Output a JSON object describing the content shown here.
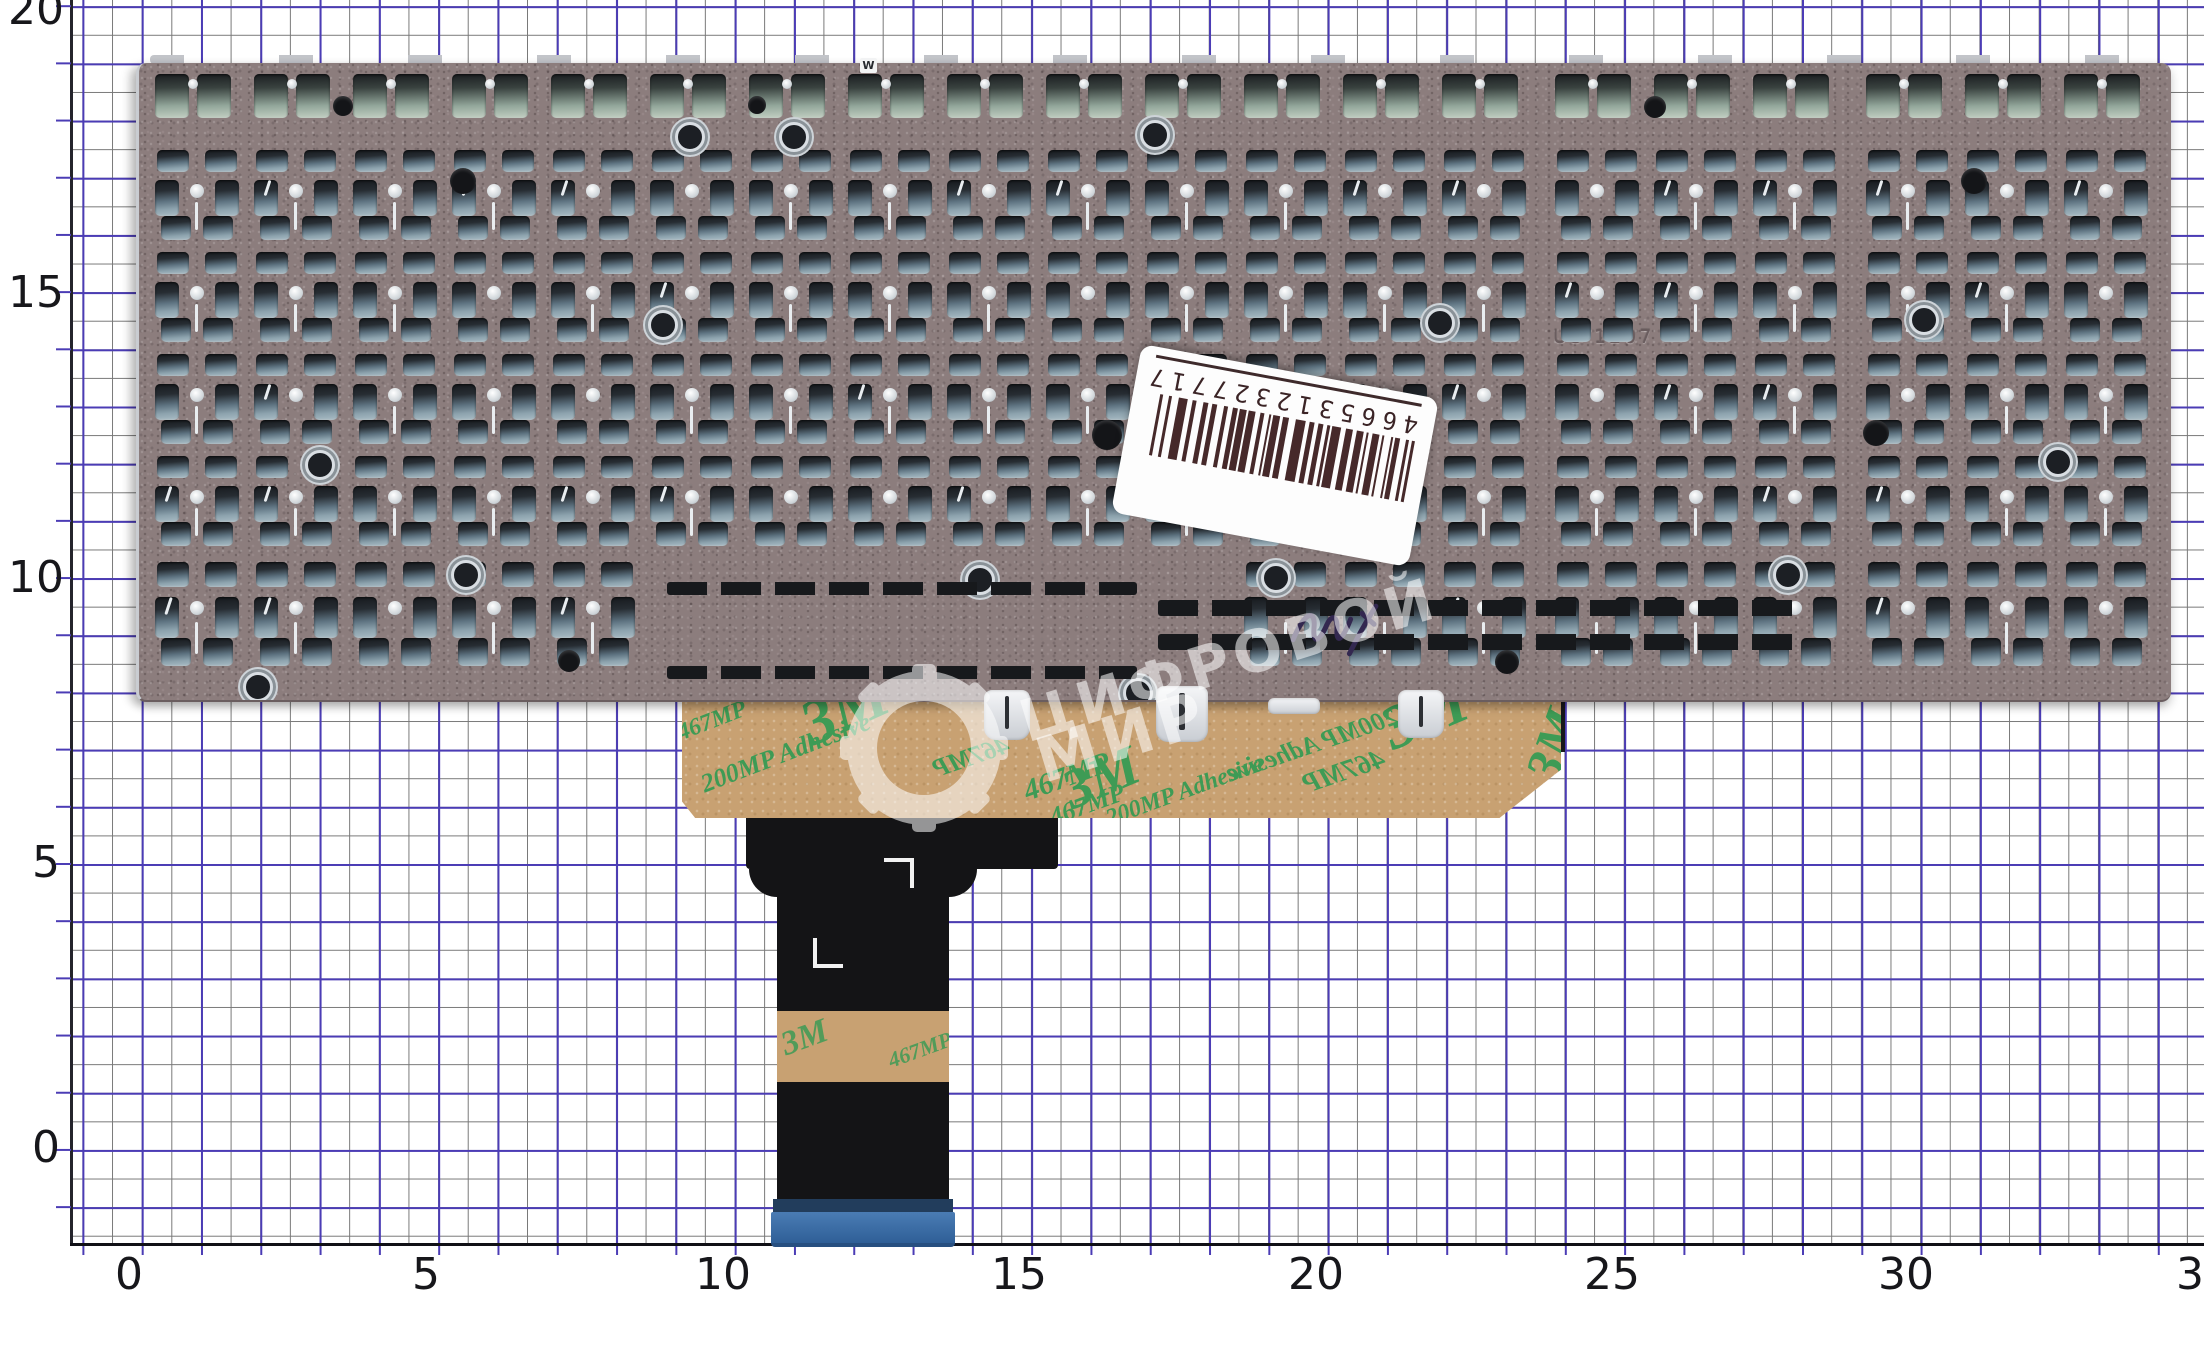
{
  "photo_subject": "laptop keyboard metal backplate on millimeter graph paper",
  "ruler": {
    "y_labels": [
      "20",
      "15",
      "10",
      "5",
      "0"
    ],
    "x_labels": [
      "0",
      "5",
      "10",
      "15",
      "20",
      "25",
      "30",
      "35"
    ]
  },
  "sticker": {
    "barcode_digits": "4665312327717"
  },
  "adhesive": {
    "brand": "3M",
    "code": "467MP",
    "name": "200MP Adhesive"
  },
  "plate": {
    "stamp_left": "US V1",
    "stamp_right": "US 1207",
    "key_marker": "W",
    "rows": [
      {
        "y": 74,
        "h": 48,
        "type": "fn"
      },
      {
        "y": 150,
        "h": 92,
        "type": "std"
      },
      {
        "y": 252,
        "h": 92,
        "type": "std"
      },
      {
        "y": 354,
        "h": 92,
        "type": "std"
      },
      {
        "y": 456,
        "h": 92,
        "type": "std"
      },
      {
        "y": 562,
        "h": 106,
        "type": "bottom"
      }
    ],
    "cols": 20
  },
  "watermark": {
    "line1": "ЦИФРОВОЙ",
    "line2": "МИР",
    "icon": "gear-icon"
  },
  "colors": {
    "paper": "#ffffff",
    "grid_minor": "#787878",
    "grid_major": "#4b3cb5",
    "plate": "#8c7d7d",
    "adhesive_tan": "#c8a172",
    "adhesive_green": "#3e9b55",
    "ribbon_black": "#141416",
    "connector_blue": "#3d72aa",
    "sticker_white": "#fdfdfd",
    "barcode_ink": "#46292a"
  }
}
